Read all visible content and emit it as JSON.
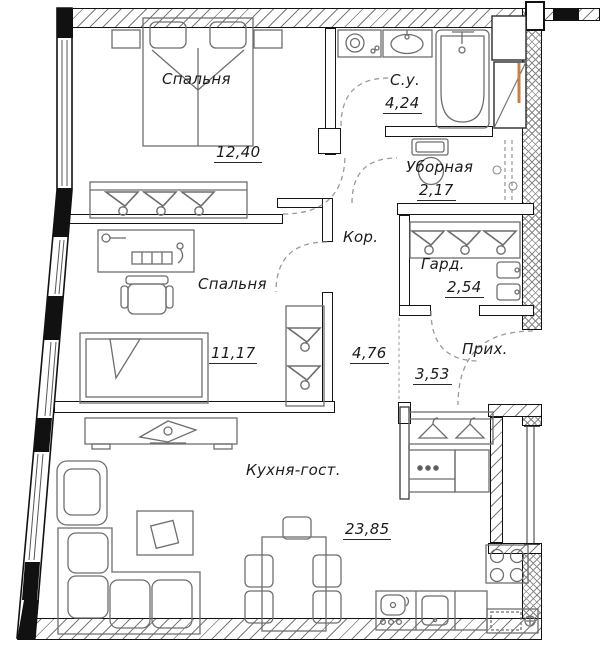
{
  "plan": {
    "type": "apartment-floor-plan",
    "language": "ru",
    "rooms": [
      {
        "id": "bedroom-1",
        "name": "Спальня",
        "area": "12,40"
      },
      {
        "id": "bathroom",
        "name": "С.у.",
        "area": "4,24"
      },
      {
        "id": "toilet",
        "name": "Уборная",
        "area": "2,17"
      },
      {
        "id": "corridor",
        "name": "Кор.",
        "area": "4,76"
      },
      {
        "id": "wardrobe-room",
        "name": "Гард.",
        "area": "2,54"
      },
      {
        "id": "bedroom-2",
        "name": "Спальня",
        "area": "11,17"
      },
      {
        "id": "hallway",
        "name": "Прих.",
        "area": "3,53"
      },
      {
        "id": "kitchen-living",
        "name": "Кухня-гост.",
        "area": "23,85"
      }
    ],
    "palette": {
      "wall_line": "#121212",
      "furniture_line": "#6e6e6e",
      "hatch_line": "#7a7a7a",
      "duct_accent_orange": "#cc8040",
      "dashed_door_arc": "#9a9a9a",
      "background": "#ffffff"
    },
    "icons": [
      "double-bed-icon",
      "nightstand-icon",
      "hanger-icon",
      "washing-machine-icon",
      "washbasin-icon",
      "bathtub-icon",
      "toilet-icon",
      "desk-icon",
      "office-chair-icon",
      "single-bed-icon",
      "closet-icon",
      "tv-stand-icon",
      "armchair-icon",
      "coffee-table-icon",
      "corner-sofa-icon",
      "dining-table-icon",
      "dining-chair-icon",
      "kitchen-sink-icon",
      "dishwasher-icon",
      "stove-icon",
      "oven-cabinet-icon",
      "coat-rack-icon",
      "shoe-cabinet-icon",
      "door-swing-arc",
      "vent-shaft-icon"
    ]
  }
}
